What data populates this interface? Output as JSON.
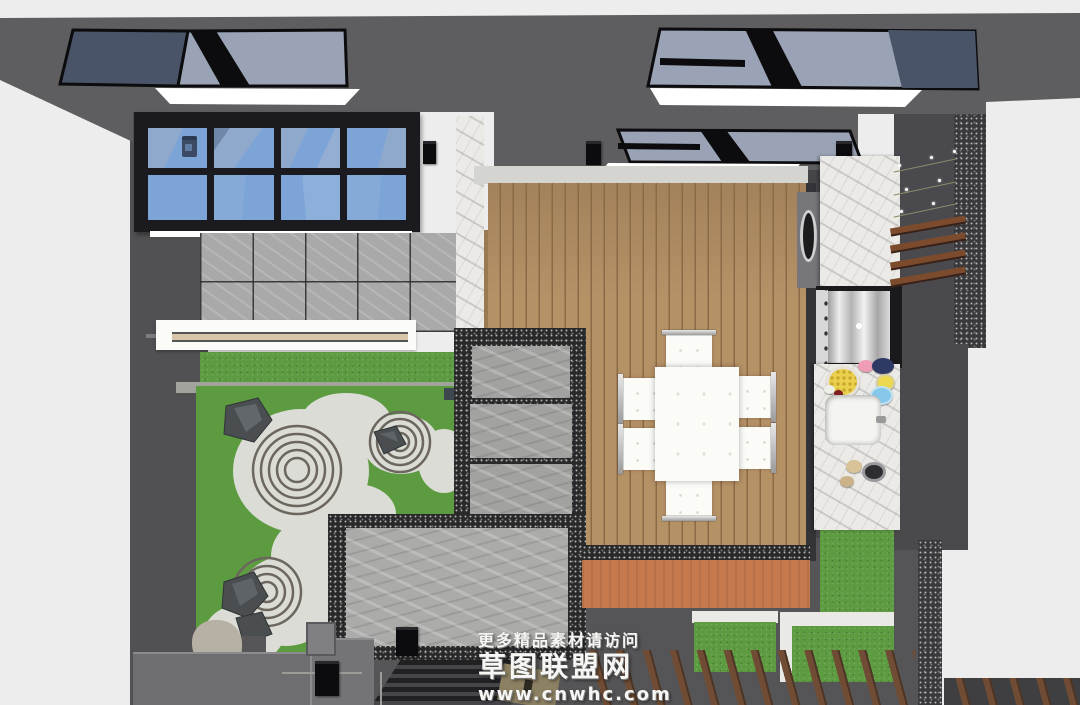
{
  "watermark": {
    "line1": "更多精品素材请访问",
    "line2": "草图联盟网",
    "line3": "www.cnwhc.com"
  },
  "scene": {
    "type": "3d-render-top-view",
    "subject": "courtyard garden with zen gravel garden, wood deck dining area and outdoor kitchen"
  },
  "colors": {
    "background": "#ededed",
    "roof": "#5e5e60",
    "wall": "#4a4a4e",
    "speckle": "#39393d",
    "ground": "#555557",
    "glass": "#9aa3b5",
    "glassdark": "#4a5468",
    "frame": "#0d0d10",
    "winglass": "#7ca4d6",
    "tile": "#a9a9a9",
    "grass": "#5d9b41",
    "gravel": "#dcdcd6",
    "slab": "#a2a2a0",
    "pebble": "#29292b",
    "deck": "#b59166",
    "deckline": "#8a6a47",
    "orange": "#c7794e",
    "marble": "#eceae6",
    "whitec": "#fbfbf8",
    "slatwood": "#7c4a2c",
    "plank": "#6f4c33",
    "stairs": "#212124"
  }
}
